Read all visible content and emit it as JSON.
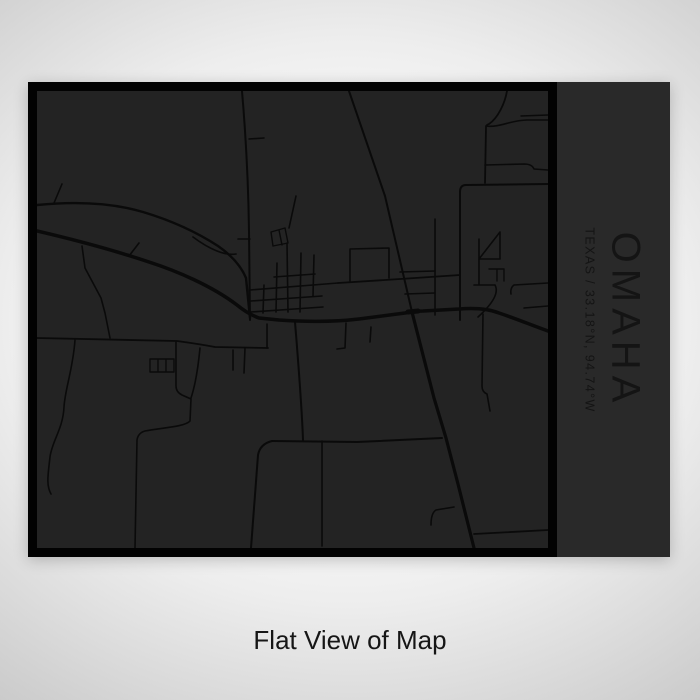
{
  "poster": {
    "title": "OMAHA",
    "subtitle": "TEXAS / 33.18°N, 94.74°W",
    "caption": "Flat View of Map",
    "colors": {
      "frame": "#020202",
      "map_bg": "#232323",
      "road": "#0a0a0a",
      "panel_bg": "#292929",
      "panel_text": "#141414",
      "caption_text": "#161616"
    },
    "map": {
      "viewbox": "0 0 511 457",
      "roads": [
        {
          "d": "M0,140 C30,147 70,157 112,171 C140,180 175,195 200,214 Q211,223 222,227 L242,229 C272,231 297,231 322,228 L368,222 Q378,220 386,220 L422,218 Q447,216 462,222 C480,228 494,234 511,240",
          "w": 3.5
        },
        {
          "d": "M312,0 L348,105 L375,221",
          "w": 2
        },
        {
          "d": "M375,221 L397,307 L409,347 L421,393 L437,457",
          "w": 3.2
        },
        {
          "d": "M371,221 L381,220",
          "w": 5
        },
        {
          "d": "M205,0 Q211,70 212,140 L213,229",
          "w": 2
        },
        {
          "d": "M212,48 L227,47",
          "w": 1.6
        },
        {
          "d": "M201,148 L213,148",
          "w": 1.6
        },
        {
          "d": "M0,114 C40,110 76,112 106,121 C136,130 161,142 181,155 C194,164 204,175 209,187 L213,227",
          "w": 2.4
        },
        {
          "d": "M156,146 C172,158 188,165 199,163",
          "w": 1.6
        },
        {
          "d": "M17,112 L25,93",
          "w": 1.6
        },
        {
          "d": "M92,165 L102,152",
          "w": 1.6
        },
        {
          "d": "M45,155 L48,177 L64,207 L68,222 L73,247",
          "w": 1.6
        },
        {
          "d": "M0,247 L140,250 Q162,253 178,256 L231,257",
          "w": 1.8
        },
        {
          "d": "M38,249 C36,278 28,298 27,316 C26,338 15,350 13,366 C11,384 9,394 14,403",
          "w": 1.6
        },
        {
          "d": "M196,259 L196,279",
          "w": 1.6
        },
        {
          "d": "M208,257 L207,282",
          "w": 1.6
        },
        {
          "d": "M230,233 L230,257",
          "w": 1.6
        },
        {
          "d": "M113,268 L137,268 L137,281 L113,281 Z M121,268 L121,281 M129,268 L129,281",
          "w": 1.4
        },
        {
          "d": "M139,251 L139,295 Q139,301 145,304 L154,308 L153,330 C148,336 122,337 108,340 Q101,342 100,349 L98,457",
          "w": 1.6
        },
        {
          "d": "M163,257 C161,278 158,295 154,307",
          "w": 1.6
        },
        {
          "d": "M237,186 L278,183",
          "w": 1.6
        },
        {
          "d": "M213,199 L301,192",
          "w": 1.6
        },
        {
          "d": "M214,210 L285,205",
          "w": 1.6
        },
        {
          "d": "M214,221 L286,216",
          "w": 1.6
        },
        {
          "d": "M227,194 L226,222",
          "w": 1.6
        },
        {
          "d": "M240,172 L239,221",
          "w": 1.6
        },
        {
          "d": "M250,152 L251,221",
          "w": 1.6
        },
        {
          "d": "M264,162 L263,221",
          "w": 1.6
        },
        {
          "d": "M277,164 L276,205",
          "w": 1.6
        },
        {
          "d": "M259,105 L252,137",
          "w": 1.6
        },
        {
          "d": "M236,155 L234,141 L248,137 L251,152 L236,155 M242,139 L245,154",
          "w": 1.4
        },
        {
          "d": "M301,192 L363,188 L423,184",
          "w": 1.8
        },
        {
          "d": "M313,158 L352,157 M313,158 L313,190 M352,157 L352,187",
          "w": 1.6
        },
        {
          "d": "M258,231 C262,280 265,320 266,349",
          "w": 2
        },
        {
          "d": "M235,350 L320,351 L405,347",
          "w": 2
        },
        {
          "d": "M235,350 Q223,353 221,364 L214,457",
          "w": 2
        },
        {
          "d": "M285,350 L285,455",
          "w": 1.6
        },
        {
          "d": "M309,232 L308,257 L300,258",
          "w": 1.6
        },
        {
          "d": "M334,236 L333,251",
          "w": 1.6
        },
        {
          "d": "M368,203 L398,202",
          "w": 1.6
        },
        {
          "d": "M363,181 L398,180",
          "w": 1.6
        },
        {
          "d": "M398,128 L398,224",
          "w": 1.6
        },
        {
          "d": "M446,223 L445,295 Q445,301 450,303 L453,320",
          "w": 1.6
        },
        {
          "d": "M442,148 L442,168 L463,168 M442,168 L463,141 L463,168",
          "w": 1.6
        },
        {
          "d": "M452,178 L467,178 M460,178 L460,190 M467,178 L467,190",
          "w": 1.4
        },
        {
          "d": "M442,168 L442,193 M437,194 L458,194 M458,194 C463,203 452,216 441,226",
          "w": 1.6
        },
        {
          "d": "M477,194 L511,192 M477,194 Q473,197 474,203",
          "w": 1.6
        },
        {
          "d": "M487,217 L511,215",
          "w": 1.6
        },
        {
          "d": "M470,0 C468,12 461,27 452,33 Q449,34 449,36 L448,92",
          "w": 1.8
        },
        {
          "d": "M449,35 C462,37 474,29 490,29 L511,29",
          "w": 1.6
        },
        {
          "d": "M448,74 L487,73 Q495,73 497,78 L511,79",
          "w": 1.6
        },
        {
          "d": "M484,25 L511,24",
          "w": 1.4
        },
        {
          "d": "M511,93 L429,94 Q423,94 423,101 L423,229",
          "w": 2
        },
        {
          "d": "M417,416 L399,419 Q394,422 394,434",
          "w": 1.6
        },
        {
          "d": "M437,443 L511,439",
          "w": 1.8
        }
      ]
    }
  }
}
